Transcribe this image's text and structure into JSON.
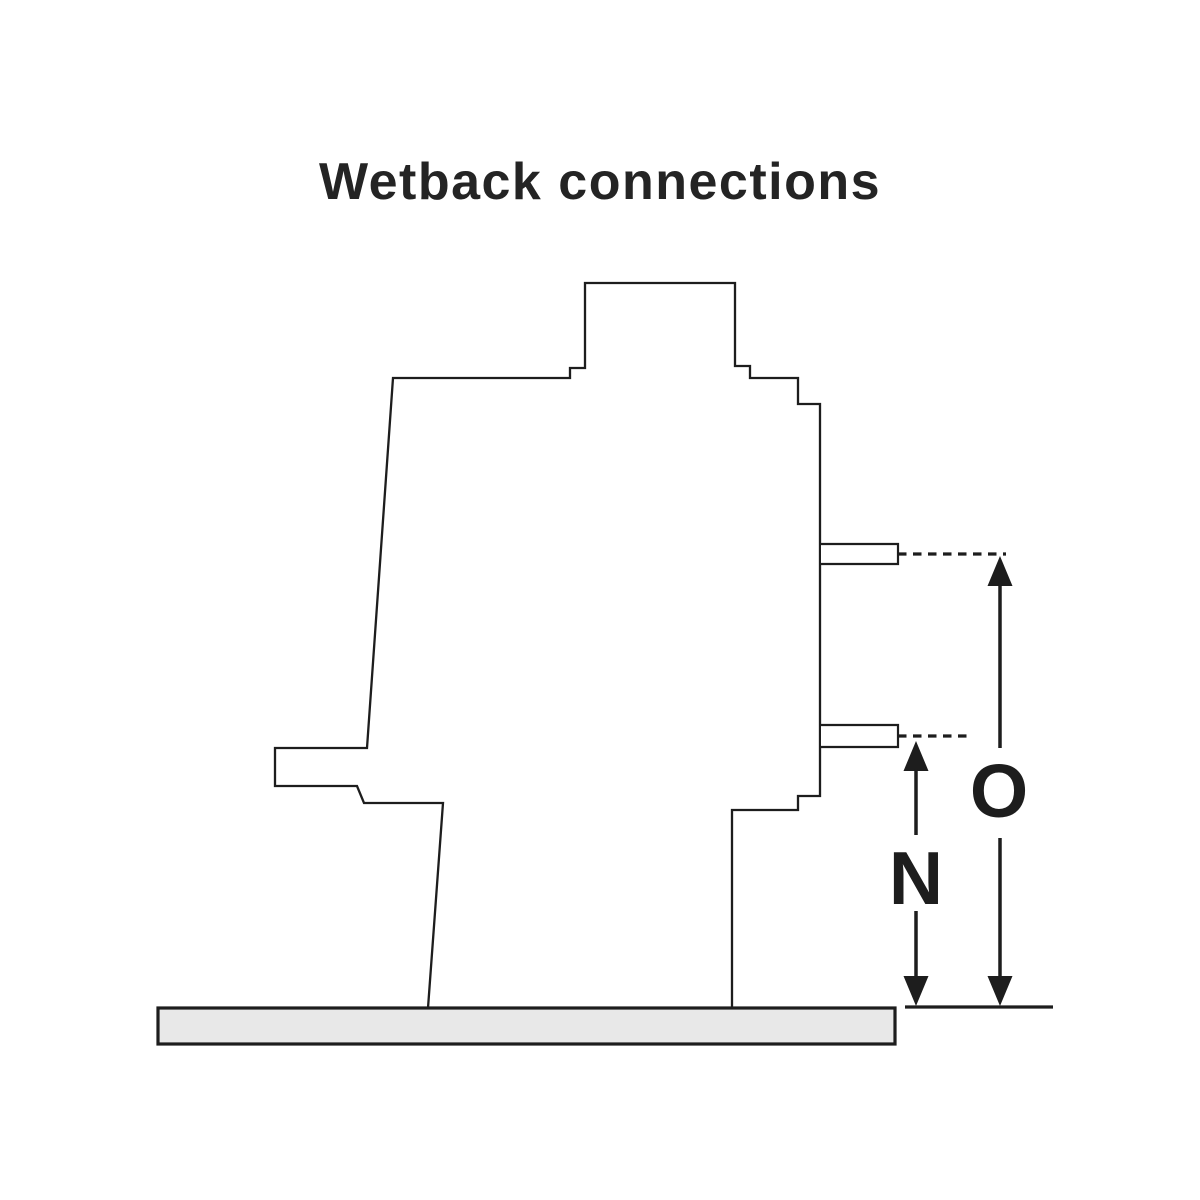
{
  "title": "Wetback connections",
  "diagram": {
    "dimension_labels": {
      "n": "N",
      "o": "O"
    }
  },
  "colors": {
    "line": "#1d1d1d",
    "title_text": "#242424",
    "floor_fill": "#e8e8e8",
    "background": "#ffffff"
  }
}
